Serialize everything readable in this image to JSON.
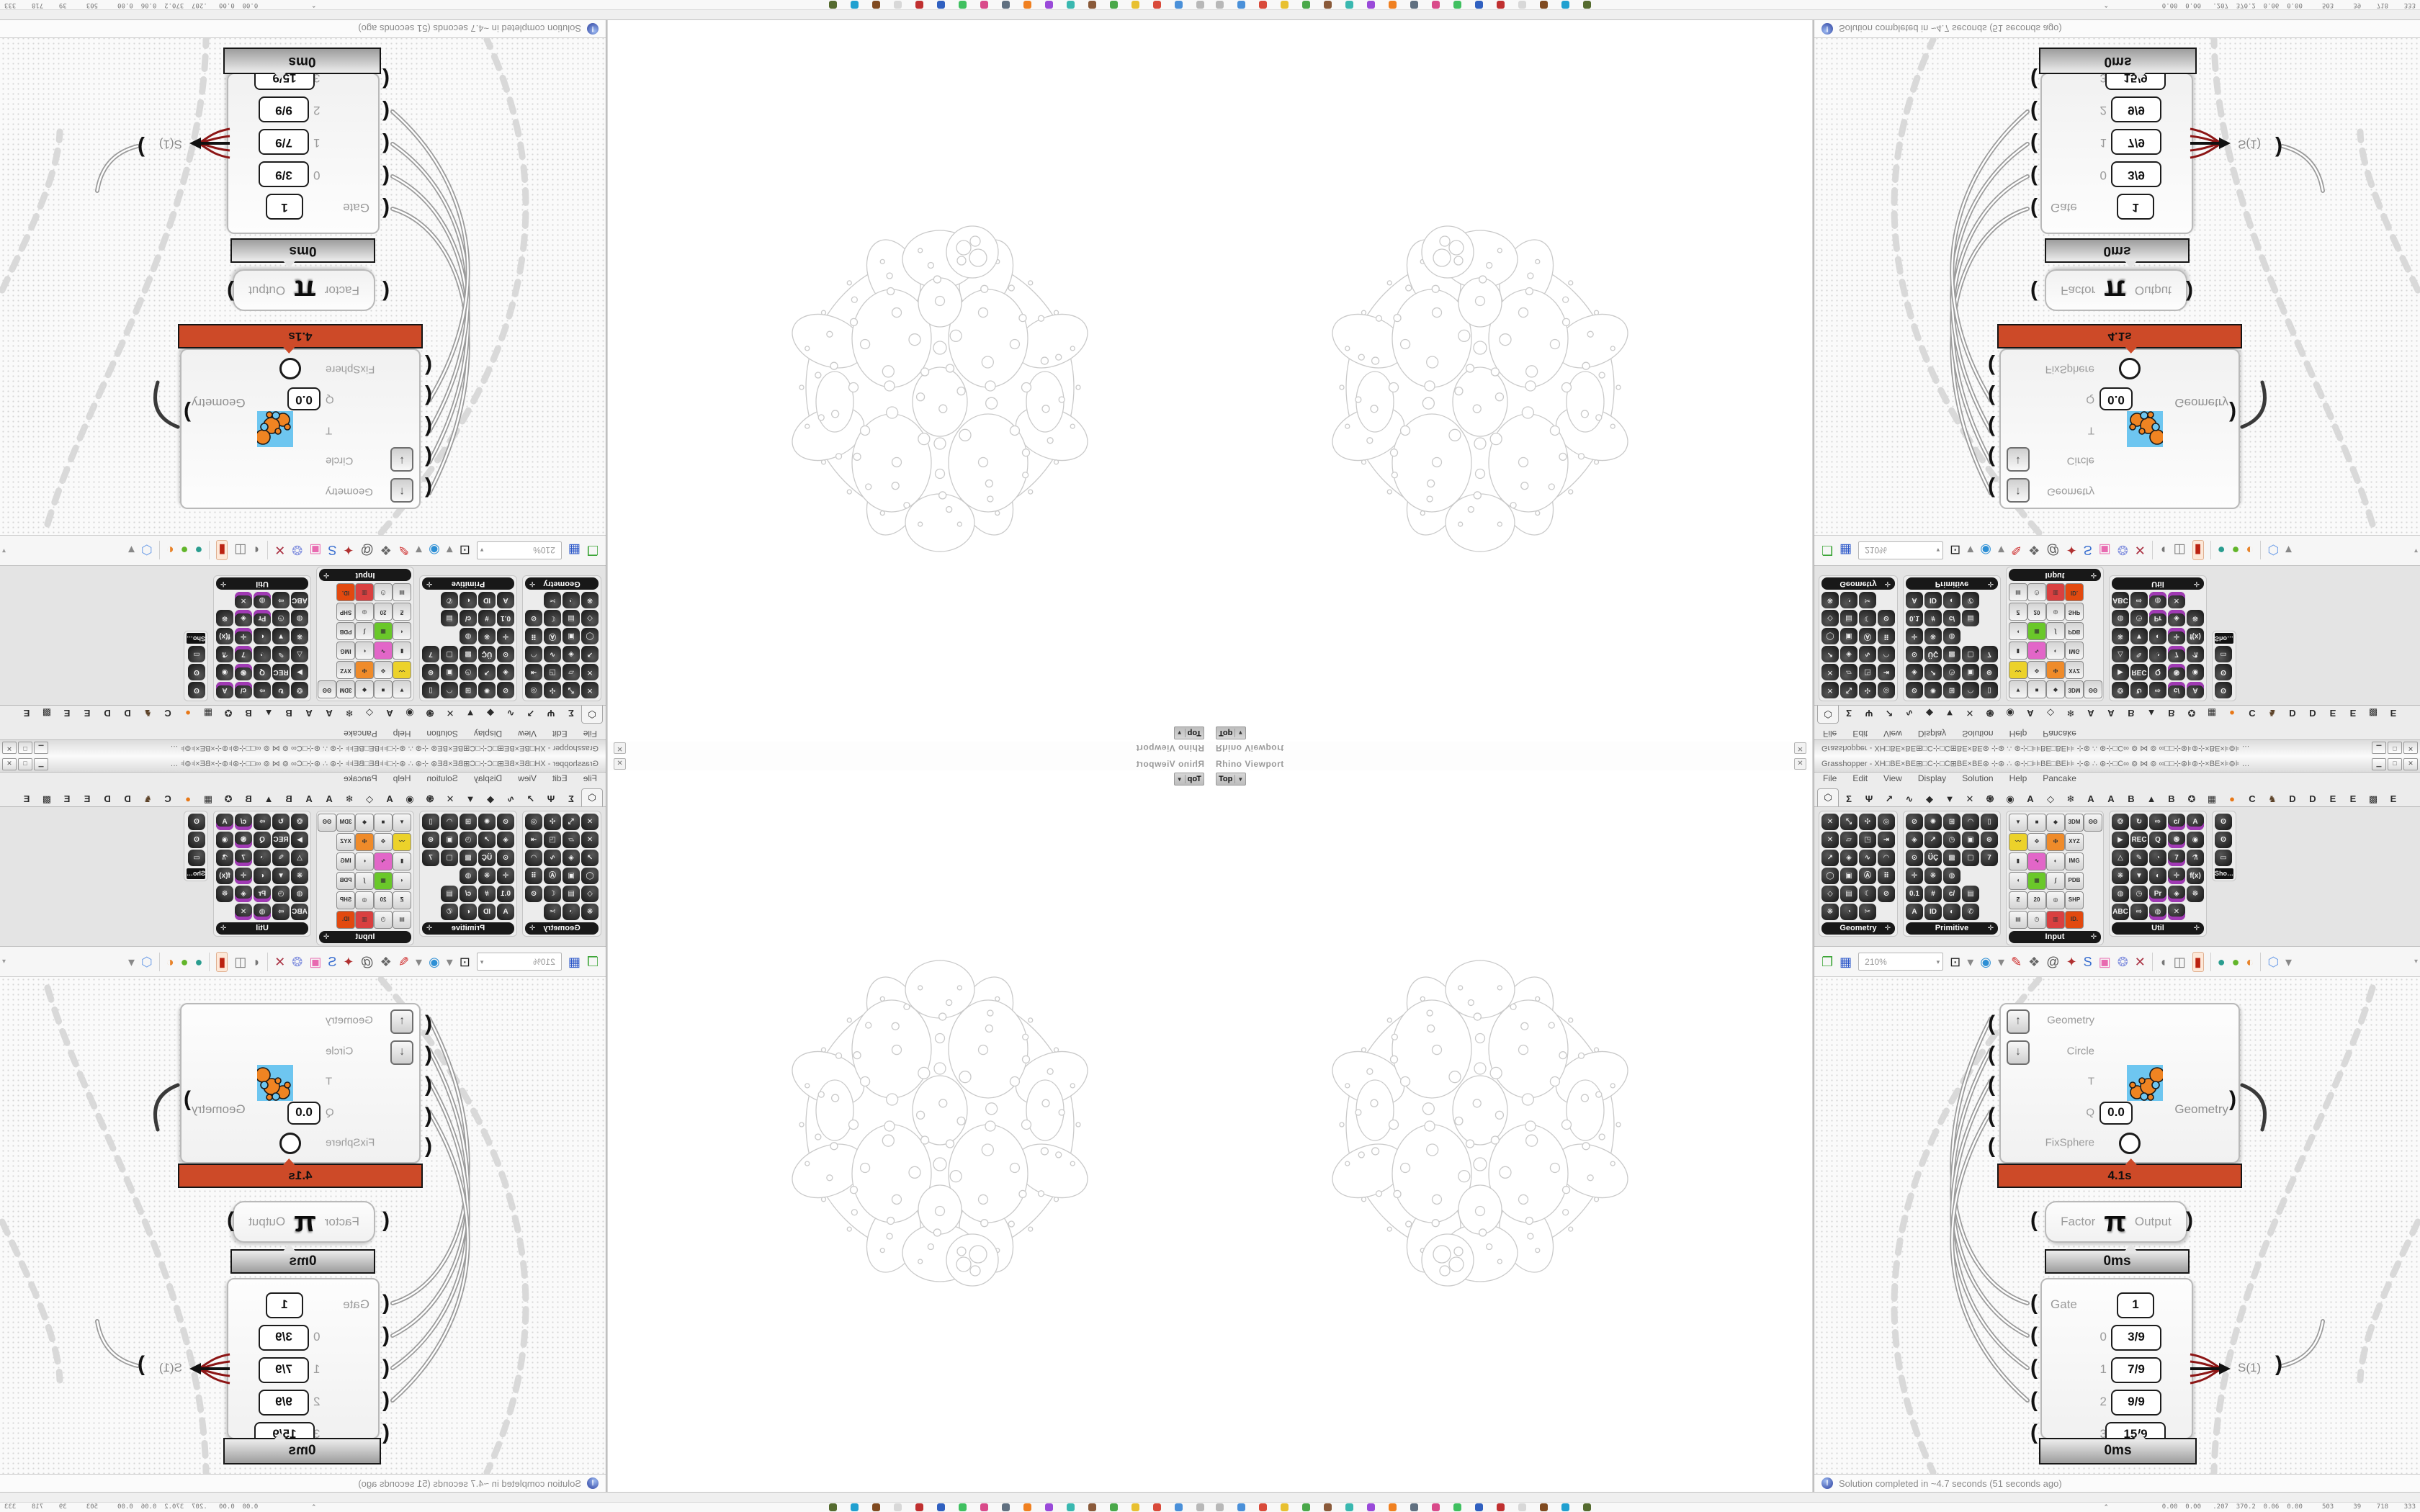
{
  "rhino": {
    "panel_title": "Rhino Viewport",
    "viewport_tab": "Top",
    "viewport_tab_caret": "▼",
    "close_glyph": "✕",
    "viewport_content": "apollonian-circle-packing-wireframe"
  },
  "gh": {
    "title": "Grasshopper - ΧΗ□ΒΕ×ΒΕ⊞□Ϲ⊹□Ϲ⊞ΒΕ×ΒΕ⊛ ⊹⊛ ∴ ⊛⊹□⊧⊧ΒΕ□ΒΕ⊧⊧ ⊹⊛ ∴ ⊛⊹□Ϲ∞ ⊚ ⋈ ⊚ ∞□□⊹⊛⊧⊚⊹×ΒΕ×⊧⊚⊧ …",
    "window_buttons": [
      "▁",
      "□",
      "✕"
    ],
    "menu": [
      "File",
      "Edit",
      "View",
      "Display",
      "Solution",
      "Help",
      "Pancake"
    ],
    "tabs": [
      {
        "name": "params",
        "glyph": "⬡",
        "active": true
      },
      {
        "name": "maths",
        "glyph": "Σ"
      },
      {
        "name": "kangaroo",
        "glyph": "Ψ"
      },
      {
        "name": "vector",
        "glyph": "↗"
      },
      {
        "name": "curve",
        "glyph": "∿"
      },
      {
        "name": "surface",
        "glyph": "◆"
      },
      {
        "name": "mesh",
        "glyph": "▼"
      },
      {
        "name": "intersect",
        "glyph": "✕"
      },
      {
        "name": "transform",
        "glyph": "֍"
      },
      {
        "name": "display",
        "glyph": "◉"
      },
      {
        "name": "plugin-a1",
        "glyph": "A"
      },
      {
        "name": "gem",
        "glyph": "◇"
      },
      {
        "name": "snowflake",
        "glyph": "❄"
      },
      {
        "name": "plugin-a2",
        "glyph": "A"
      },
      {
        "name": "plugin-a3",
        "glyph": "A"
      },
      {
        "name": "plugin-b1",
        "glyph": "B"
      },
      {
        "name": "mountain",
        "glyph": "▲"
      },
      {
        "name": "plugin-b2",
        "glyph": "B"
      },
      {
        "name": "shield",
        "glyph": "✪"
      },
      {
        "name": "grid",
        "glyph": "▦"
      },
      {
        "name": "orange-dot",
        "glyph": "●",
        "color": "#e87817"
      },
      {
        "name": "plugin-c",
        "glyph": "C"
      },
      {
        "name": "bird",
        "glyph": "♞",
        "color": "#5a4026"
      },
      {
        "name": "plugin-d1",
        "glyph": "D"
      },
      {
        "name": "plugin-d2",
        "glyph": "D"
      },
      {
        "name": "plugin-e1",
        "glyph": "E"
      },
      {
        "name": "plugin-e2",
        "glyph": "E"
      },
      {
        "name": "pattern",
        "glyph": "▩"
      },
      {
        "name": "plugin-e3",
        "glyph": "E"
      }
    ],
    "palette": {
      "groups": [
        {
          "label": "Geometry",
          "cols": 4,
          "style": "hex",
          "icons": [
            "✕",
            "⤡",
            "✣",
            "◎",
            "✕",
            "▱",
            "◳",
            "⇥",
            "↗",
            "◈",
            "∿",
            "◠",
            "◯",
            "▣",
            "Ⓐ",
            "⠿",
            "◇",
            "▤",
            "☾",
            "⊘",
            "❋",
            "◔",
            "✂",
            ""
          ]
        },
        {
          "label": "Primitive",
          "cols": 5,
          "style": "hex",
          "icons": [
            "⊘",
            "✺",
            "⊞",
            "◠",
            "▯",
            "◈",
            "↗",
            "◷",
            "▣",
            "⊛",
            "⊙",
            "ÜÇ",
            "▩",
            "▢",
            "7",
            "✛",
            "❋",
            "◍",
            "",
            "",
            "0.1",
            "#",
            "c/",
            "▤",
            "",
            "A",
            "ID",
            "◐",
            "✆",
            ""
          ]
        },
        {
          "label": "Input",
          "cols": 5,
          "style": "btn",
          "icons": [
            "▼",
            "■",
            "◆",
            "3DM",
            "ʘʘ",
            "〰|#ecd22a",
            "✥",
            "🜊|#ef8b2a",
            "XYZ",
            "",
            "▮",
            "∿|#e266c8",
            "◐",
            "IMG",
            "",
            "◖",
            "▦|#6ac82a",
            "∫",
            "PDB",
            "",
            "Ƶ",
            "20",
            "◎",
            "SHP",
            "",
            "▤",
            "◷",
            "▥|#d94040",
            "ID.|#e2490f",
            ""
          ]
        },
        {
          "label": "Util",
          "cols": 5,
          "style": "hex",
          "icons": [
            "❂",
            "↻",
            "⇨",
            "c/*",
            "A*",
            "▶",
            "REC",
            "Q",
            "֍*",
            "◉",
            "△",
            "✎",
            "◔",
            "7*",
            "⚗",
            "❋",
            "▼",
            "◐",
            "✛*",
            "f(x)",
            "◍",
            "◷",
            "Pr*",
            "◈*",
            "☸",
            "ABC",
            "⇨",
            "◍*",
            "✕*",
            ""
          ]
        },
        {
          "label": "Sho…",
          "cols": 1,
          "style": "hex",
          "chip": true,
          "icons": [
            "ʘ",
            "ʘ",
            "▭"
          ]
        }
      ]
    },
    "toolbar": {
      "zoom_value": "210%",
      "zoom_caret": "▾",
      "end_caret": "▾",
      "icons": [
        {
          "name": "open-file",
          "glyph": "❐",
          "color": "#3aa435"
        },
        {
          "name": "save-file",
          "glyph": "▦",
          "color": "#2b57c9"
        },
        {
          "name": "zoom-level",
          "type": "zoom"
        },
        {
          "name": "zoom-extents",
          "glyph": "⊡",
          "color": "#222"
        },
        {
          "name": "caret-1",
          "glyph": "▾",
          "color": "#888"
        },
        {
          "name": "preview-eye",
          "glyph": "◉",
          "color": "#2d8fd5"
        },
        {
          "name": "caret-2",
          "glyph": "▾",
          "color": "#888"
        },
        {
          "name": "sketch-pen",
          "glyph": "✎",
          "color": "#cc2222"
        },
        {
          "name": "camera-lamp",
          "glyph": "❖",
          "color": "#666"
        },
        {
          "name": "remote-panel",
          "glyph": "@",
          "color": "#555"
        },
        {
          "name": "gha-doc",
          "glyph": "✦",
          "color": "#b03030"
        },
        {
          "name": "search-s",
          "glyph": "S",
          "color": "#3a6fd0"
        },
        {
          "name": "gift-box",
          "glyph": "▣",
          "color": "#e86ab0"
        },
        {
          "name": "twin-bulbs",
          "glyph": "❂",
          "color": "#8a97e0"
        },
        {
          "name": "crossed-wires",
          "glyph": "✕",
          "color": "#aa3344"
        },
        {
          "name": "sep-1",
          "type": "sep"
        },
        {
          "name": "preview-off",
          "glyph": "◖",
          "color": "#777"
        },
        {
          "name": "preview-wire",
          "glyph": "◫",
          "color": "#777"
        },
        {
          "name": "preview-shaded",
          "glyph": "▮",
          "color": "#bb2211",
          "highlight": true
        },
        {
          "name": "sep-2",
          "type": "sep"
        },
        {
          "name": "blob-teal",
          "glyph": "●",
          "color": "#2a9d8f"
        },
        {
          "name": "blob-green",
          "glyph": "●",
          "color": "#62b52a"
        },
        {
          "name": "ball-orange",
          "glyph": "◐",
          "color": "#e8832a"
        },
        {
          "name": "sep-3",
          "type": "sep"
        },
        {
          "name": "hex-blue",
          "glyph": "⬡",
          "color": "#6f9fe8"
        },
        {
          "name": "caret-3",
          "glyph": "▾",
          "color": "#888"
        }
      ]
    },
    "canvas": {
      "cluster": {
        "inputs": [
          "Geometry",
          "Circle",
          "T",
          "Q",
          "FixSphere"
        ],
        "q_value": "0.0",
        "output": "Geometry",
        "profiler": "4.1s"
      },
      "pi_node": {
        "input": "Factor",
        "symbol": "π",
        "output": "Output",
        "profiler": "0ms"
      },
      "gate_node": {
        "gate_label": "Gate",
        "gate_value": "1",
        "rows": [
          {
            "index": "0",
            "value": "3/9"
          },
          {
            "index": "1",
            "value": "7/9"
          },
          {
            "index": "2",
            "value": "9/9"
          },
          {
            "index": "3",
            "value": "15/9"
          }
        ],
        "output": "S(1)",
        "profiler": "0ms"
      }
    },
    "status": "Solution completed in ~4.7 seconds (51 seconds ago)"
  },
  "os": {
    "taskbar_numbers": "0.00  0.00   .207  370.2  0.06  0.00     503     39    718    333",
    "taskbar_caret": "⌃",
    "taskbar_icon_colors": [
      "#b8b8b8",
      "#4a90d9",
      "#d94a3a",
      "#e8c030",
      "#4aa84a",
      "#8a5a3a",
      "#3ab8b0",
      "#9a4ad9",
      "#f08020",
      "#607080",
      "#d94a8a",
      "#40c060",
      "#3060c0",
      "#c03030",
      "#d8d8d8",
      "#804a20",
      "#20a0d0",
      "#556b2f"
    ]
  },
  "accents": {
    "profiler_orange": "#cd4a28",
    "canvas_dot": "#d6d6d6",
    "dash_gray": "#d9d9d9",
    "wire_gray": "#9c9c9c",
    "packing_stroke": "#cacaca"
  }
}
